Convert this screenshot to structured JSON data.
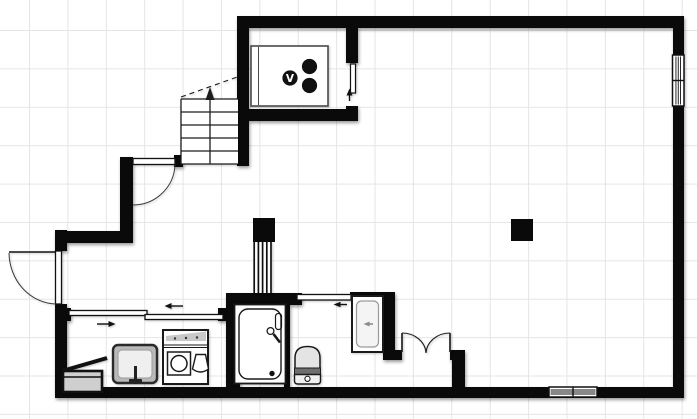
{
  "canvas": {
    "width": 697,
    "height": 419,
    "background": "#ffffff",
    "grid": {
      "spacing": 38.4,
      "offset_x": 29,
      "offset_y": 30,
      "line_color": "#e5e5e5"
    }
  },
  "palette": {
    "wall": "#0a0a0a",
    "line": "#1a1a1a",
    "fixture_fill": "#ffffff",
    "panel_gray": "#c9c9c9",
    "seat_gray": "#6e6e6e",
    "basin_gray": "#b9b9b9"
  },
  "stove": {
    "burner_glyph": "V"
  },
  "walls": [
    {
      "name": "wall-top",
      "x": 237,
      "y": 16,
      "w": 447,
      "h": 12
    },
    {
      "name": "wall-right",
      "x": 673,
      "y": 16,
      "w": 11,
      "h": 382
    },
    {
      "name": "wall-bottom",
      "x": 55,
      "y": 387,
      "w": 629,
      "h": 11
    },
    {
      "name": "wall-left-upper",
      "x": 55,
      "y": 230,
      "w": 12,
      "h": 21
    },
    {
      "name": "wall-left-lower",
      "x": 55,
      "y": 304,
      "w": 12,
      "h": 94
    },
    {
      "name": "wall-entry-horizontal",
      "x": 55,
      "y": 231,
      "w": 78,
      "h": 12
    },
    {
      "name": "wall-entry-vertical",
      "x": 120,
      "y": 157,
      "w": 13,
      "h": 86
    },
    {
      "name": "wall-hall-door-post",
      "x": 174,
      "y": 155,
      "w": 9,
      "h": 12
    },
    {
      "name": "wall-stair-kitchen-left",
      "x": 237,
      "y": 16,
      "w": 12,
      "h": 150
    },
    {
      "name": "wall-kitchen-bottom",
      "x": 237,
      "y": 109,
      "w": 121,
      "h": 12
    },
    {
      "name": "wall-kitchen-right-upper",
      "x": 346,
      "y": 16,
      "w": 12,
      "h": 47
    },
    {
      "name": "wall-kitchen-right-lower",
      "x": 346,
      "y": 106,
      "w": 12,
      "h": 15
    },
    {
      "name": "wall-washroom-jamb-left",
      "x": 62,
      "y": 308,
      "w": 9,
      "h": 13
    },
    {
      "name": "wall-washroom-jamb-right",
      "x": 218,
      "y": 308,
      "w": 10,
      "h": 13
    },
    {
      "name": "wall-bath-left",
      "x": 226,
      "y": 293,
      "w": 14,
      "h": 105
    },
    {
      "name": "wall-bath-top",
      "x": 226,
      "y": 293,
      "w": 76,
      "h": 12
    },
    {
      "name": "wall-bath-right",
      "x": 284,
      "y": 297,
      "w": 6,
      "h": 93
    },
    {
      "name": "wall-toilet-top",
      "x": 350,
      "y": 292,
      "w": 45,
      "h": 7
    },
    {
      "name": "wall-toilet-right",
      "x": 383,
      "y": 292,
      "w": 12,
      "h": 68
    },
    {
      "name": "wall-closet-left",
      "x": 383,
      "y": 350,
      "w": 19,
      "h": 10
    },
    {
      "name": "wall-closet-right",
      "x": 450,
      "y": 350,
      "w": 15,
      "h": 10
    },
    {
      "name": "wall-closet-right-vertical",
      "x": 452,
      "y": 350,
      "w": 13,
      "h": 40
    }
  ],
  "columns": [
    {
      "name": "column-center",
      "x": 253,
      "y": 218,
      "w": 22,
      "h": 24
    },
    {
      "name": "column-right",
      "x": 511,
      "y": 219,
      "w": 22,
      "h": 22
    }
  ],
  "windows": [
    {
      "name": "window-right-wall",
      "x": 672.5,
      "y": 55,
      "w": 11.5,
      "h": 51,
      "orientation": "vertical"
    },
    {
      "name": "window-bottom-wall",
      "x": 549,
      "y": 387,
      "w": 48,
      "h": 10,
      "orientation": "horizontal"
    }
  ],
  "doors": [
    "entrance-swing-door",
    "hall-swing-door",
    "washroom-double-sliding-door",
    "toilet-sliding-door",
    "kitchen-sliding-door",
    "closet-double-swing-door"
  ],
  "fixtures": [
    "staircase-up",
    "kitchen-counter-with-stove",
    "duct-shaft",
    "washing-machine",
    "washroom-sink",
    "storage-box-open-lid",
    "bathtub",
    "toilet",
    "hand-wash-basin"
  ]
}
